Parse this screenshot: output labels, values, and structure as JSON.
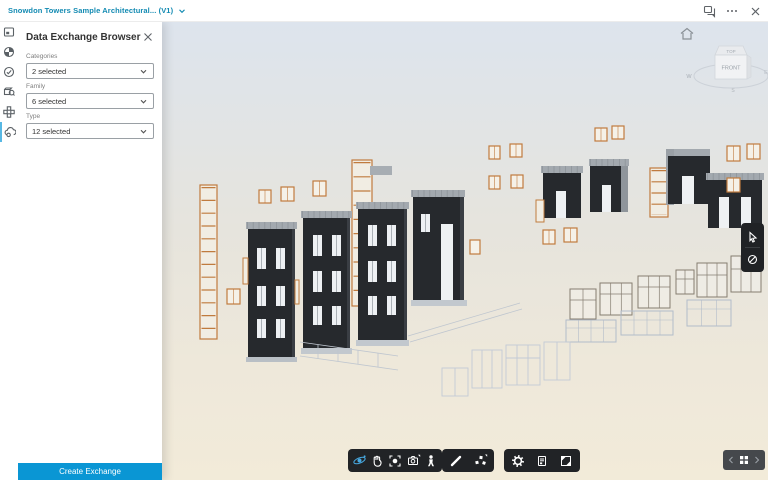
{
  "topbar": {
    "title": "Snowdon Towers Sample Architectural... (V1)"
  },
  "panel": {
    "title": "Data Exchange Browser",
    "fields": [
      {
        "label": "Categories",
        "value": "2 selected"
      },
      {
        "label": "Family",
        "value": "6 selected"
      },
      {
        "label": "Type",
        "value": "12 selected"
      }
    ],
    "create_button_label": "Create Exchange"
  },
  "viewcube": {
    "top_label": "TOP",
    "front_label": "FRONT",
    "west_label": "W",
    "east_label": "E",
    "south_label": "S"
  },
  "colors": {
    "accent_blue": "#0a96d4",
    "title_teal": "#128ab2",
    "toolbar_dark": "#212326",
    "orbit_active_blue": "#47a8e0",
    "facade_dark": "#26292d",
    "frame_orange": "#c07b3e",
    "sky_top": "#dde4ed",
    "sky_bottom": "#f2ebd9"
  }
}
